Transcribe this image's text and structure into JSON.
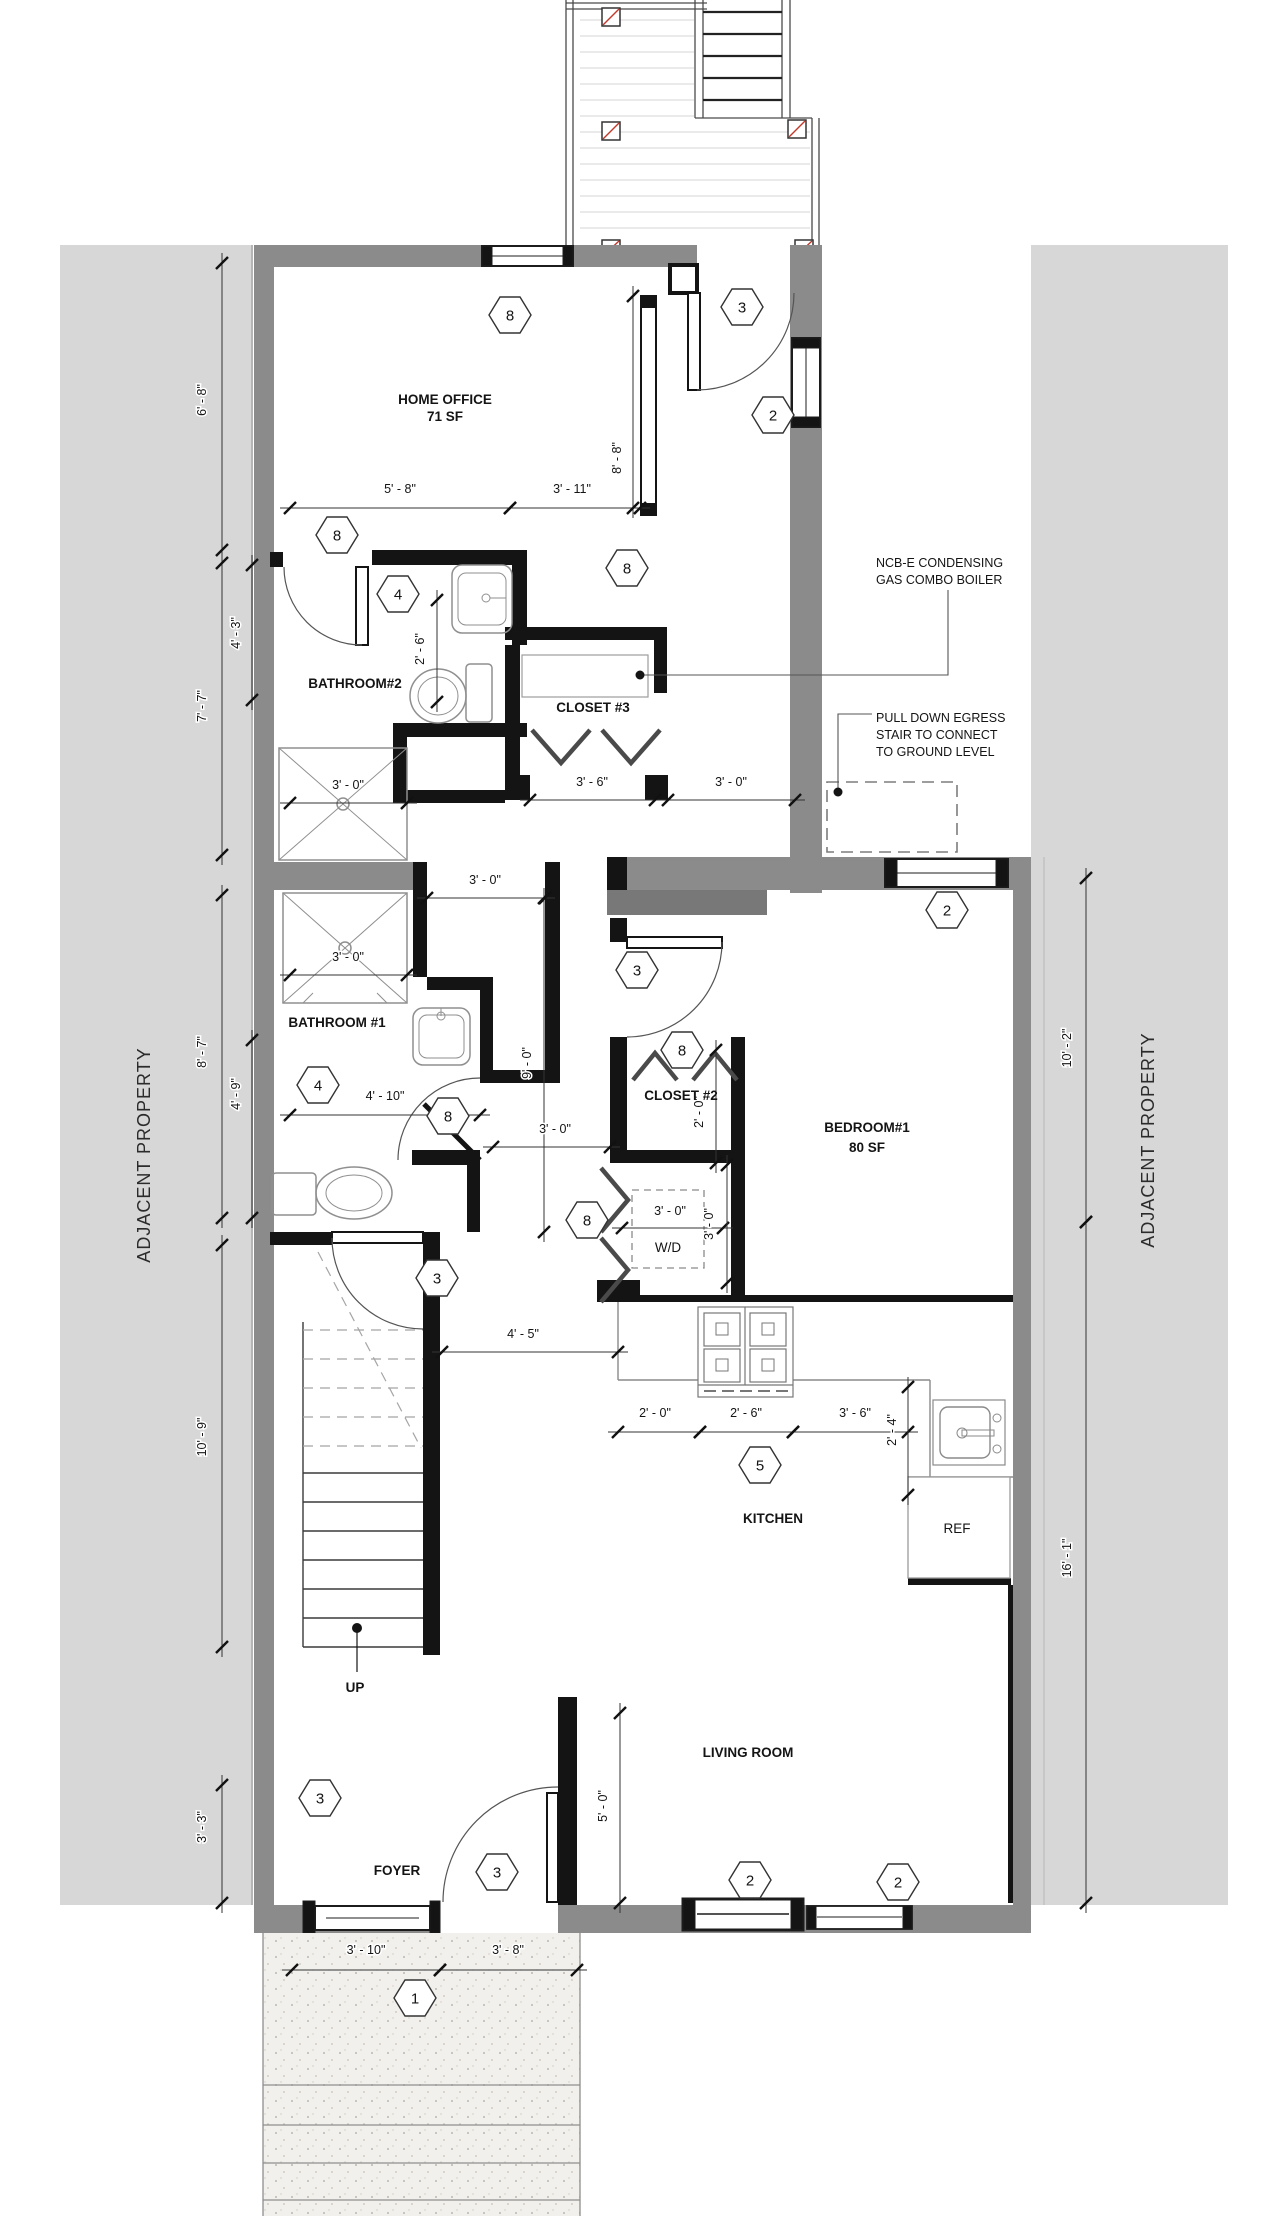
{
  "drawing": {
    "property_left": "ADJACENT PROPERTY",
    "property_right": "ADJACENT PROPERTY"
  },
  "rooms": {
    "home_office": {
      "name": "HOME OFFICE",
      "area": "71 SF"
    },
    "bathroom2": {
      "name": "BATHROOM#2"
    },
    "closet3": {
      "name": "CLOSET #3"
    },
    "bathroom1": {
      "name": "BATHROOM #1"
    },
    "closet2": {
      "name": "CLOSET #2"
    },
    "bedroom1": {
      "name": "BEDROOM#1",
      "area": "80 SF"
    },
    "laundry": {
      "name": "W/D"
    },
    "kitchen": {
      "name": "KITCHEN"
    },
    "living_room": {
      "name": "LIVING ROOM"
    },
    "foyer": {
      "name": "FOYER"
    },
    "stairs": {
      "name": "UP"
    },
    "fridge": {
      "name": "REF"
    }
  },
  "notes": {
    "boiler_line1": "NCB-E CONDENSING",
    "boiler_line2": "GAS COMBO BOILER",
    "egress_line1": "PULL DOWN EGRESS",
    "egress_line2": "STAIR TO CONNECT",
    "egress_line3": "TO GROUND LEVEL"
  },
  "callouts": [
    {
      "n": "8",
      "x": 510,
      "y": 315
    },
    {
      "n": "3",
      "x": 742,
      "y": 307
    },
    {
      "n": "2",
      "x": 773,
      "y": 415
    },
    {
      "n": "8",
      "x": 337,
      "y": 535
    },
    {
      "n": "8",
      "x": 627,
      "y": 568
    },
    {
      "n": "4",
      "x": 398,
      "y": 594
    },
    {
      "n": "2",
      "x": 947,
      "y": 910
    },
    {
      "n": "3",
      "x": 637,
      "y": 970
    },
    {
      "n": "8",
      "x": 682,
      "y": 1050
    },
    {
      "n": "4",
      "x": 318,
      "y": 1085
    },
    {
      "n": "8",
      "x": 448,
      "y": 1116
    },
    {
      "n": "8",
      "x": 587,
      "y": 1220
    },
    {
      "n": "5",
      "x": 760,
      "y": 1465
    },
    {
      "n": "3",
      "x": 437,
      "y": 1278
    },
    {
      "n": "3",
      "x": 320,
      "y": 1798
    },
    {
      "n": "3",
      "x": 497,
      "y": 1872
    },
    {
      "n": "2",
      "x": 750,
      "y": 1880
    },
    {
      "n": "2",
      "x": 898,
      "y": 1882
    },
    {
      "n": "1",
      "x": 415,
      "y": 1998
    }
  ],
  "dims": [
    {
      "t": "6' - 8\"",
      "tx": 206,
      "ty": 400,
      "rot": -90,
      "l": [
        222,
        263,
        222,
        550
      ]
    },
    {
      "t": "4' - 3\"",
      "tx": 240,
      "ty": 633,
      "rot": -90,
      "l": [
        252,
        565,
        252,
        700
      ]
    },
    {
      "t": "7' - 7\"",
      "tx": 206,
      "ty": 706,
      "rot": -90,
      "l": [
        222,
        563,
        222,
        855
      ]
    },
    {
      "t": "8' - 7\"",
      "tx": 206,
      "ty": 1052,
      "rot": -90,
      "l": [
        222,
        895,
        222,
        1218
      ]
    },
    {
      "t": "4' - 9\"",
      "tx": 240,
      "ty": 1094,
      "rot": -90,
      "l": [
        252,
        1040,
        252,
        1218
      ]
    },
    {
      "t": "10' - 9\"",
      "tx": 206,
      "ty": 1437,
      "rot": -90,
      "l": [
        222,
        1245,
        222,
        1647
      ]
    },
    {
      "t": "3' - 3\"",
      "tx": 206,
      "ty": 1827,
      "rot": -90,
      "l": [
        222,
        1785,
        222,
        1903
      ]
    },
    {
      "t": "10' - 2\"",
      "tx": 1071,
      "ty": 1048,
      "rot": -90,
      "l": [
        1086,
        878,
        1086,
        1222
      ]
    },
    {
      "t": "16' - 1\"",
      "tx": 1071,
      "ty": 1558,
      "rot": -90,
      "l": [
        1086,
        1222,
        1086,
        1903
      ]
    },
    {
      "t": "5' - 8\"",
      "tx": 400,
      "ty": 493,
      "rot": 0,
      "l": [
        290,
        508,
        510,
        508
      ]
    },
    {
      "t": "3' - 11\"",
      "tx": 572,
      "ty": 493,
      "rot": 0,
      "l": [
        510,
        508,
        640,
        508
      ]
    },
    {
      "t": "8' - 8\"",
      "tx": 621,
      "ty": 458,
      "rot": -90,
      "l": [
        633,
        296,
        633,
        508
      ]
    },
    {
      "t": "2' - 6\"",
      "tx": 424,
      "ty": 649,
      "rot": -90,
      "l": [
        437,
        600,
        437,
        702
      ]
    },
    {
      "t": "3' - 0\"",
      "tx": 348,
      "ty": 789,
      "rot": 0,
      "l": [
        290,
        803,
        407,
        803
      ]
    },
    {
      "t": "3' - 6\"",
      "tx": 592,
      "ty": 786,
      "rot": 0,
      "l": [
        530,
        800,
        655,
        800
      ]
    },
    {
      "t": "3' - 0\"",
      "tx": 731,
      "ty": 786,
      "rot": 0,
      "l": [
        668,
        800,
        795,
        800
      ]
    },
    {
      "t": "3' - 0\"",
      "tx": 348,
      "ty": 961,
      "rot": 0,
      "l": [
        290,
        975,
        407,
        975
      ]
    },
    {
      "t": "3' - 0\"",
      "tx": 485,
      "ty": 884,
      "rot": 0,
      "l": [
        427,
        898,
        545,
        898
      ]
    },
    {
      "t": "9' - 0\"",
      "tx": 531,
      "ty": 1063,
      "rot": -90,
      "l": [
        544,
        898,
        544,
        1232
      ]
    },
    {
      "t": "4' - 10\"",
      "tx": 385,
      "ty": 1100,
      "rot": 0,
      "l": [
        290,
        1115,
        480,
        1115
      ]
    },
    {
      "t": "3' - 0\"",
      "tx": 555,
      "ty": 1133,
      "rot": 0,
      "l": [
        493,
        1147,
        610,
        1147
      ]
    },
    {
      "t": "2' - 0\"",
      "tx": 703,
      "ty": 1112,
      "rot": -90,
      "l": [
        716,
        1050,
        716,
        1163
      ]
    },
    {
      "t": "3' - 0\"",
      "tx": 670,
      "ty": 1215,
      "rot": 0,
      "l": [
        622,
        1228,
        723,
        1228
      ]
    },
    {
      "t": "3' - 0\"",
      "tx": 713,
      "ty": 1224,
      "rot": -90,
      "l": [
        727,
        1165,
        727,
        1283
      ]
    },
    {
      "t": "2' - 0\"",
      "tx": 655,
      "ty": 1417,
      "rot": 0,
      "l": [
        618,
        1432,
        700,
        1432
      ]
    },
    {
      "t": "2' - 6\"",
      "tx": 746,
      "ty": 1417,
      "rot": 0,
      "l": [
        700,
        1432,
        793,
        1432
      ]
    },
    {
      "t": "3' - 6\"",
      "tx": 855,
      "ty": 1417,
      "rot": 0,
      "l": [
        793,
        1432,
        908,
        1432
      ]
    },
    {
      "t": "2' - 4\"",
      "tx": 896,
      "ty": 1430,
      "rot": -90,
      "l": [
        908,
        1387,
        908,
        1495
      ]
    },
    {
      "t": "4' - 5\"",
      "tx": 523,
      "ty": 1338,
      "rot": 0,
      "l": [
        442,
        1352,
        618,
        1352
      ]
    },
    {
      "t": "5' - 0\"",
      "tx": 607,
      "ty": 1806,
      "rot": -90,
      "l": [
        620,
        1713,
        620,
        1903
      ]
    },
    {
      "t": "3' - 10\"",
      "tx": 366,
      "ty": 1954,
      "rot": 0,
      "l": [
        292,
        1970,
        440,
        1970
      ]
    },
    {
      "t": "3' - 8\"",
      "tx": 508,
      "ty": 1954,
      "rot": 0,
      "l": [
        440,
        1970,
        577,
        1970
      ]
    }
  ]
}
